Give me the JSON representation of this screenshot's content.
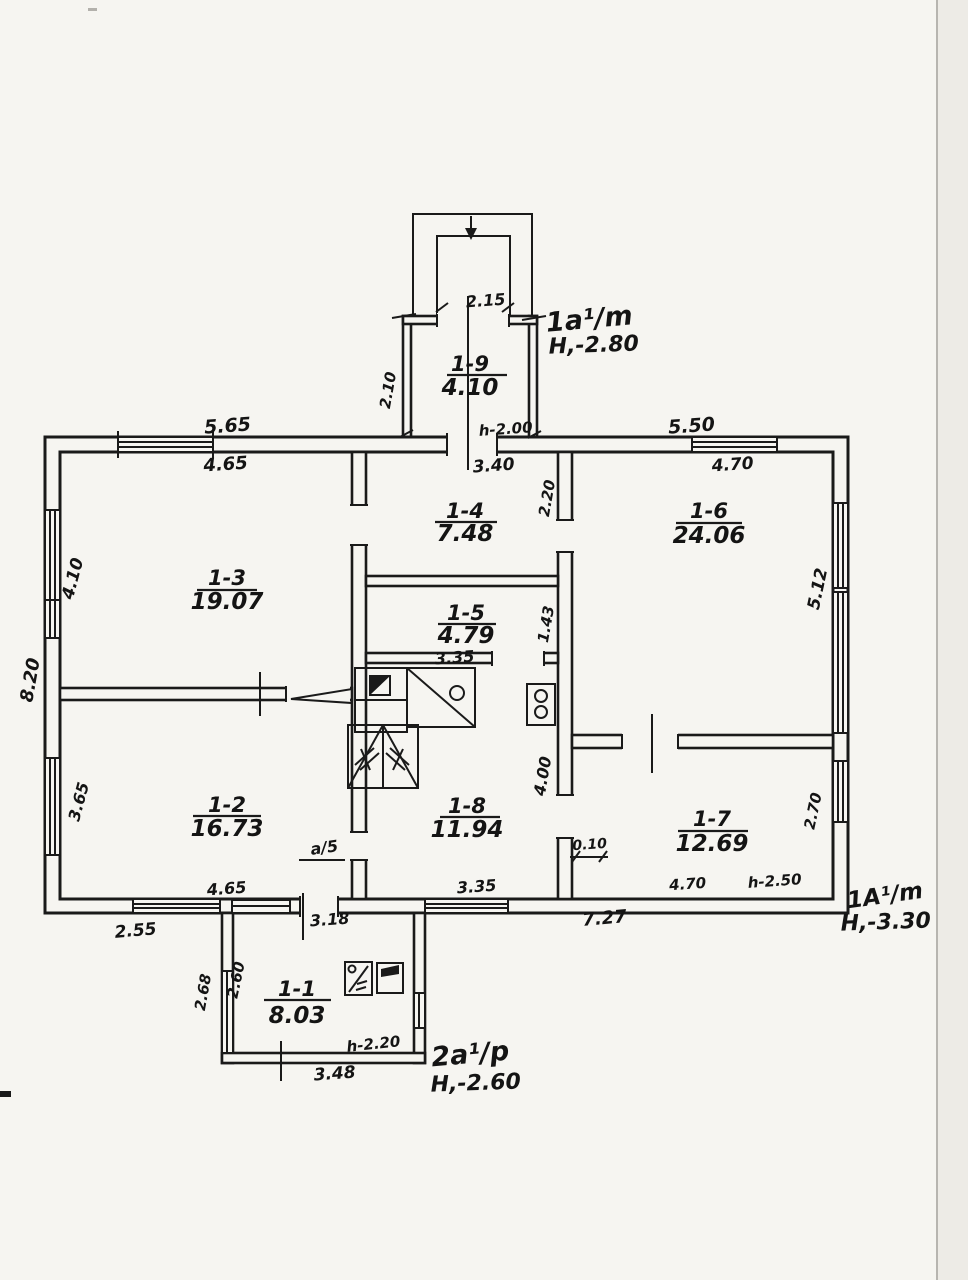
{
  "plan": {
    "rooms": {
      "r11": {
        "code": "1-1",
        "area": "8.03"
      },
      "r12": {
        "code": "1-2",
        "area": "16.73"
      },
      "r13": {
        "code": "1-3",
        "area": "19.07"
      },
      "r14": {
        "code": "1-4",
        "area": "7.48"
      },
      "r15": {
        "code": "1-5",
        "area": "4.79"
      },
      "r16": {
        "code": "1-6",
        "area": "24.06"
      },
      "r17": {
        "code": "1-7",
        "area": "12.69"
      },
      "r18": {
        "code": "1-8",
        "area": "11.94"
      },
      "r19": {
        "code": "1-9",
        "area": "4.10"
      }
    },
    "dims": {
      "porch_width": "2.15",
      "vestibule_depth": "2.10",
      "entry_door": "h-2.00",
      "top_left_outer": "5.65",
      "r13_width": "4.65",
      "top_right_outer": "5.50",
      "r16_width": "4.70",
      "r13_height": "4.10",
      "left_total": "8.20",
      "r12_height": "3.65",
      "r14_width": "3.40",
      "r14_height": "2.20",
      "r15_height": "1.43",
      "r15_width": "3.35",
      "r16_height": "5.12",
      "r18_height": "4.00",
      "wall_offset": "0.10",
      "door_mark": "a/5",
      "r18_width": "3.35",
      "r17_height": "2.70",
      "r12_width": "4.65",
      "bottom_left_outer": "2.55",
      "r11_top_width": "3.18",
      "bottom_right_outer": "7.27",
      "r17_width": "4.70",
      "r17_door": "h-2.50",
      "r11_left_outer": "2.68",
      "r11_left_inner": "2.60",
      "r11_door": "h-2.20",
      "r11_bottom_width": "3.48"
    },
    "zones": {
      "vestibule": {
        "mark": "1a¹/m",
        "elevation": "H,-2.80"
      },
      "main": {
        "mark": "1A¹/m",
        "elevation": "H,-3.30"
      },
      "annex": {
        "mark": "2a¹/p",
        "elevation": "H,-2.60"
      }
    }
  }
}
